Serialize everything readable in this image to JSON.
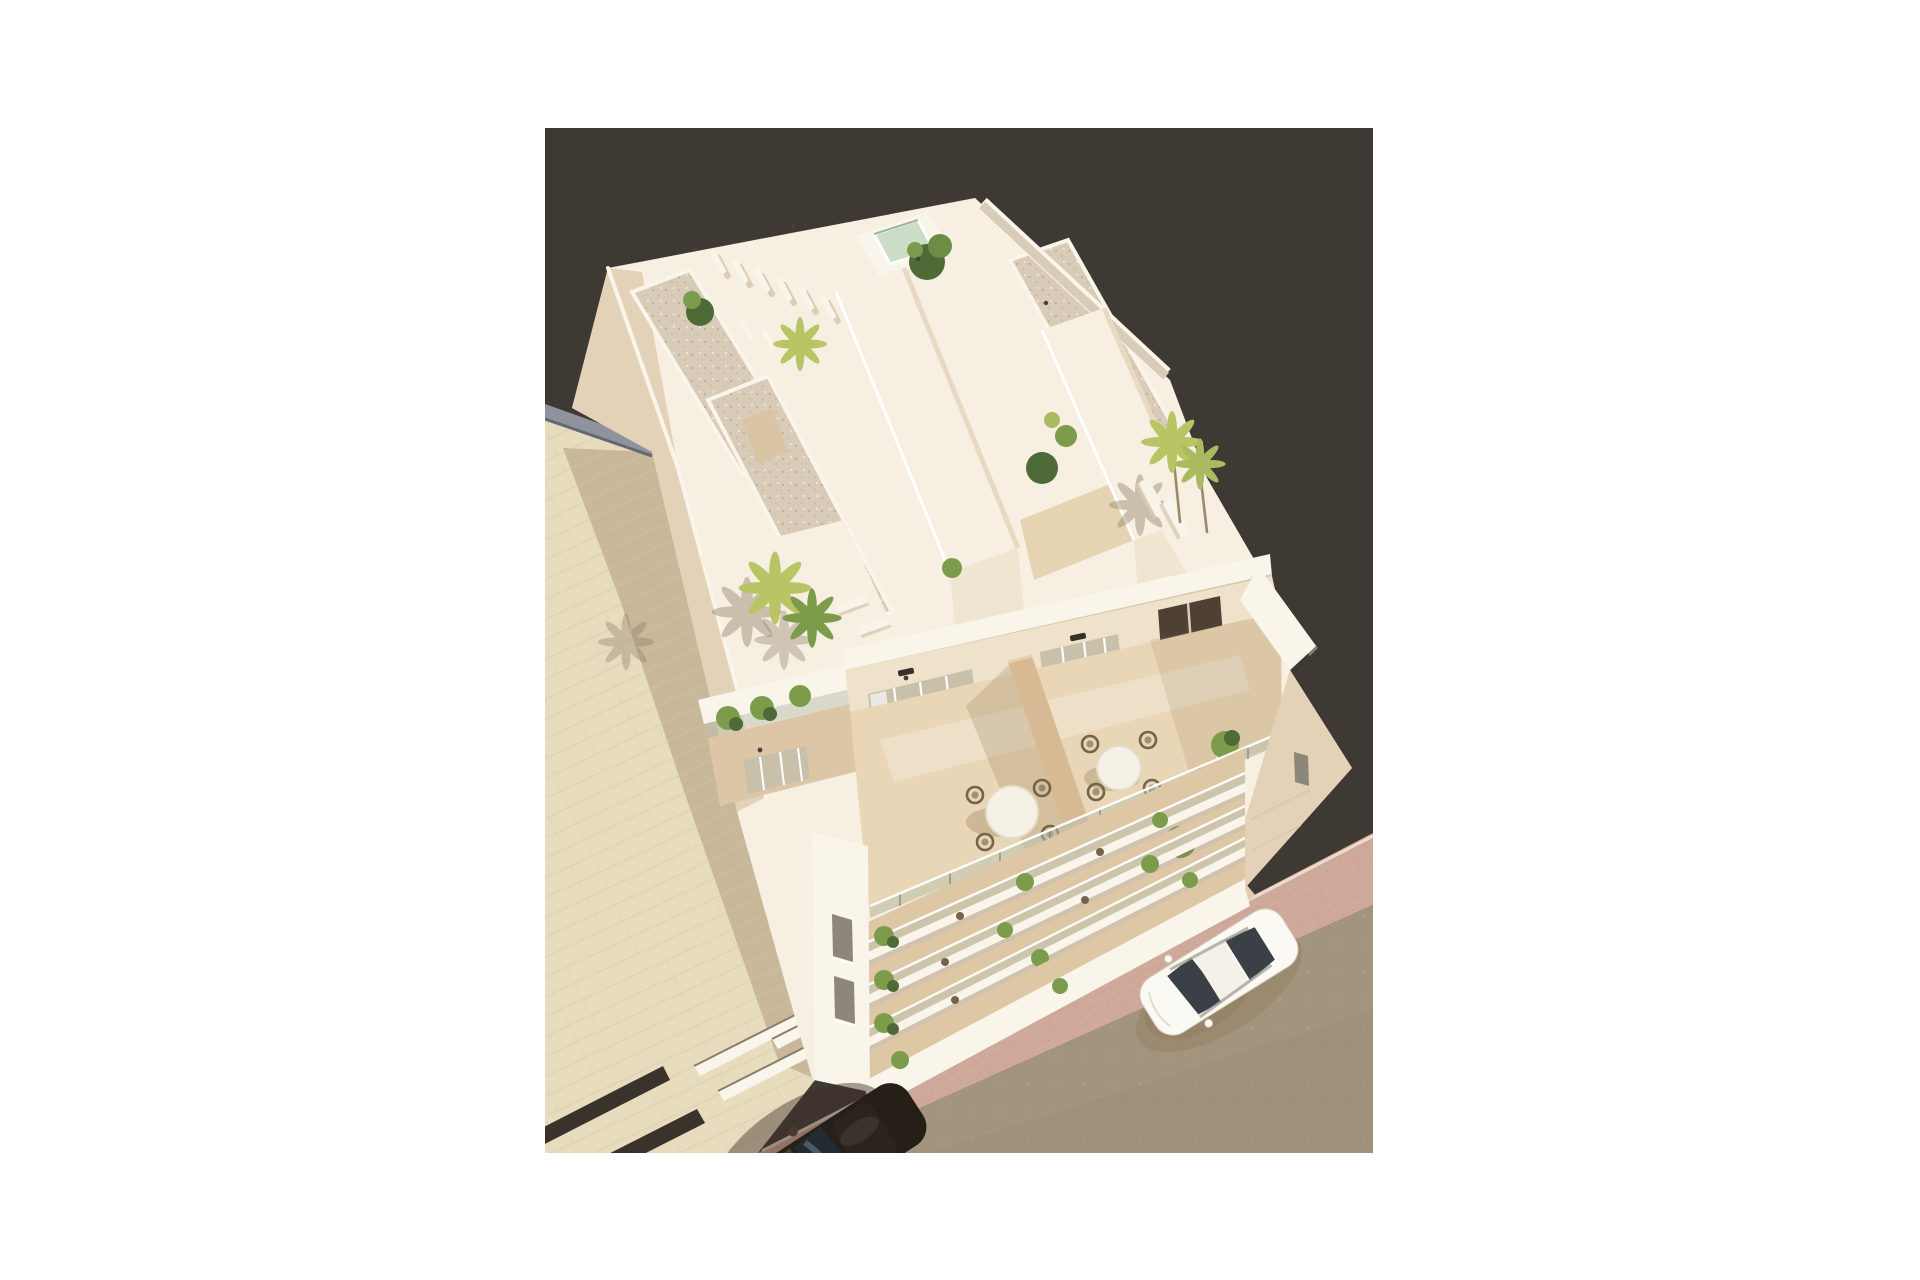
{
  "page": {
    "background": "#ffffff"
  },
  "photo": {
    "left": 545,
    "top": 128,
    "width": 828,
    "height": 1025,
    "description": "Aerial 3D architectural rendering of a cream-white apartment building seen from above: rooftop terraces with gravel borders, pergola, small plunge pool and palm trees; a middle terrace with two round dining tables and wicker chairs behind glass balustrades; four stacked balcony rows with plants; a tiled plaza with the building's long shadow, dark road markings and recessed skylight slats on the left; a brick sidewalk and grey-tan street with a parked white car on the right and a dark car at the bottom edge"
  },
  "palette": {
    "page_bg": "#ffffff",
    "photo_bg": "#3e3a33",
    "plaza": "#e8dcbf",
    "plaza_joint": "#d6c5a3",
    "shadow_soft": "#8a6f4f",
    "wall_strip": "#8f939c",
    "street": "#a3947d",
    "sidewalk": "#cfa99a",
    "sidewalk_light": "#e3c9b6",
    "sidewalk_joint": "#bd9788",
    "curb": "#ecdccd",
    "stripe_dark": "#3a332c",
    "white_lit": "#faf5ea",
    "white_top": "#f6efe2",
    "cream": "#f0e5d1",
    "cream_shadow": "#e3d2b8",
    "deep_shadow": "#c9b394",
    "gravel": "#d8cbb7",
    "gravel_dot": "#b3a287",
    "pool": "#cbdcc7",
    "glass": "#c8c0ab",
    "glass_dark": "#8d867a",
    "storefront": "#4e4134",
    "terrace_floor": "#e9d6b6",
    "divider": "#d7b994",
    "rail_glass": "#b9c4b2",
    "green_dark": "#4e6a37",
    "green_mid": "#7d9c4b",
    "green_light": "#a9bb5e",
    "palm": "#b9c465",
    "palm_shadow": "#8a7a60",
    "trunk": "#9a8a6a",
    "wicker": "#77624a",
    "table_white": "#f6f1e6",
    "edge_line": "#d9c9ad",
    "car_white": "#fbf9f4",
    "car_glass": "#3a4046",
    "darkcar_body": "#261f18",
    "darkcar_hood": "#4b3a31",
    "darkcar_glass": "#232a31",
    "darkcar_streak": "#5d707c"
  },
  "scene": {
    "backdrop": "dark studio backdrop",
    "ground": {
      "plaza": "tiled plaza with building shadow",
      "road_markings": 2,
      "pavement_skylights": 3,
      "boundary_wall": "grey boundary wall",
      "sidewalk": "brick sidewalk",
      "street": "grey-tan street"
    },
    "building": {
      "label": "cream apartment building, aerial view",
      "roof": [
        "gravel roof borders",
        "pergola slats",
        "plunge pool",
        "two stair cores",
        "roof palms",
        "sun loungers"
      ],
      "terrace": [
        "two round dining tables",
        "wicker chairs",
        "privacy divider",
        "glass balustrade",
        "sliding glass doors",
        "dark glazed entrance"
      ],
      "balcony_rows": 4
    },
    "vehicles": [
      {
        "label": "white car parked on street"
      },
      {
        "label": "dark car at bottom edge"
      }
    ]
  }
}
